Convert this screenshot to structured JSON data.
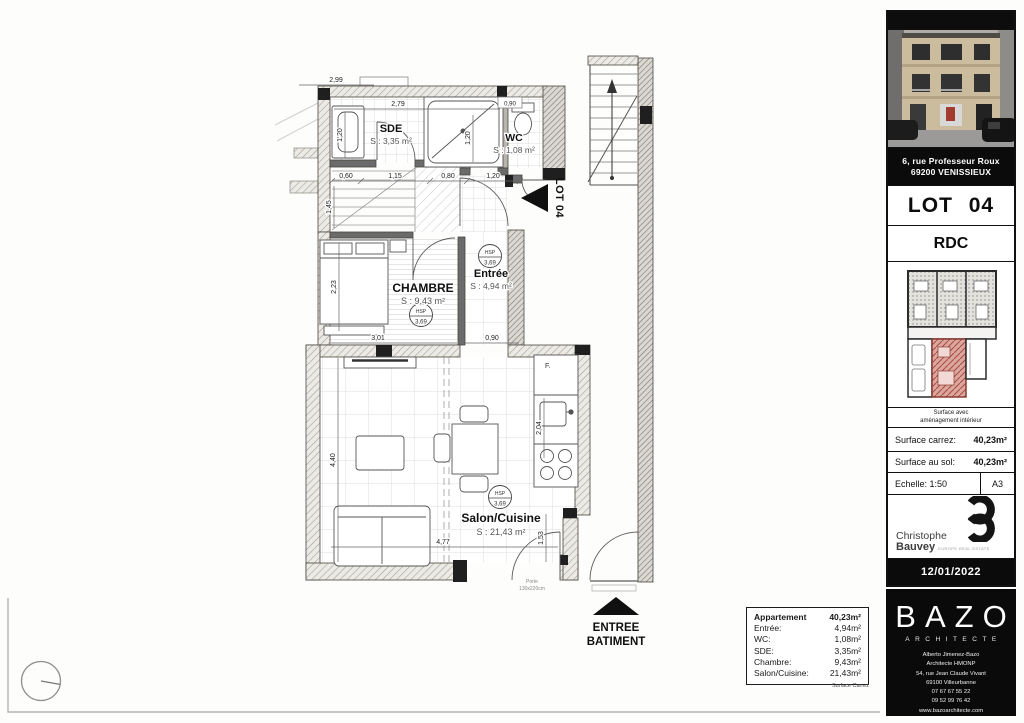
{
  "colors": {
    "highlight_red": "#b5544c",
    "ink": "#111111"
  },
  "plan": {
    "rooms": {
      "sde": {
        "name": "SDE",
        "area": "S : 3,35 m²"
      },
      "wc": {
        "name": "WC",
        "area": "S : 1,08 m²"
      },
      "chambre": {
        "name": "CHAMBRE",
        "area": "S : 9,43 m²"
      },
      "entree": {
        "name": "Entrée",
        "area": "S : 4,94 m²"
      },
      "salon": {
        "name": "Salon/Cuisine",
        "area": "S : 21,43 m²"
      }
    },
    "hsp": {
      "label": "HSP",
      "value": "3,69"
    },
    "dims": {
      "top_width": "2,99",
      "sde_width": "2,79",
      "wc_top": "0,90",
      "wc_depth": "1,20",
      "sde_left": "1,20",
      "row_a": "0,60",
      "row_b": "1,15",
      "row_c": "0,80",
      "row_d": "1,20",
      "stair_depth": "1,45",
      "chambre_left": "2,23",
      "chambre_width": "3,01",
      "entree_width": "0,90",
      "salon_depth": "4,40",
      "salon_width": "4,77",
      "salon_right": "1,53",
      "kitchen_depth": "2,04"
    },
    "lot_tag": "LOT 04",
    "fridge_label": "F.",
    "door_note_1": "Porte",
    "door_note_2": "130x220cm",
    "entrance_1": "ENTREE",
    "entrance_2": "BATIMENT"
  },
  "surface_table": {
    "rows": [
      {
        "label": "Appartement",
        "value": "40,23m²"
      },
      {
        "label": "Entrée:",
        "value": "4,94m²"
      },
      {
        "label": "WC:",
        "value": "1,08m²"
      },
      {
        "label": "SDE:",
        "value": "3,35m²"
      },
      {
        "label": "Chambre:",
        "value": "9,43m²"
      },
      {
        "label": "Salon/Cuisine:",
        "value": "21,43m²"
      }
    ],
    "footnote": "Surface Carrez"
  },
  "titleblock": {
    "address_line1": "6, rue Professeur Roux",
    "address_line2": "69200 VENISSIEUX",
    "lot": "LOT 04",
    "level": "RDC",
    "keyplan_caption_1": "Surface avec",
    "keyplan_caption_2": "aménagement intérieur",
    "carrez_label": "Surface carrez:",
    "carrez_value": "40,23m²",
    "floor_label": "Surface au sol:",
    "floor_value": "40,23m²",
    "scale_label": "Echelle: 1:50",
    "paper_size": "A3",
    "agency_name_1": "Christophe",
    "agency_name_2": "Bauvey",
    "agency_tagline": "EUROPE REAL ESTATE",
    "date": "12/01/2022",
    "firm_name": "BAZO",
    "firm_subtitle": "ARCHITECTE",
    "firm_lines": [
      "Alberto Jimenez-Bazo",
      "Architecte HMONP",
      "54, rue Jean Claude Vivant",
      "69100 Villeurbanne",
      "07 67 67 55 22",
      "09 52 99 76 42",
      "www.bazoarchitecte.com"
    ]
  }
}
